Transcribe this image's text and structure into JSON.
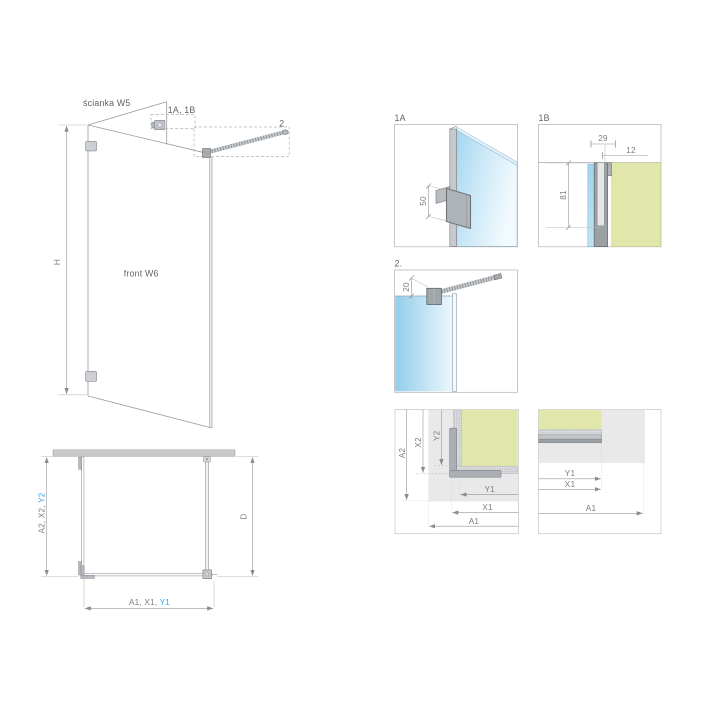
{
  "view3d": {
    "wall_panel_label": "ścianka W5",
    "front_panel_label": "front W6",
    "height_label": "H",
    "callout_1ab": "1A, 1B",
    "callout_2": "2"
  },
  "plan": {
    "left_dim_prefix": "A2, X2, ",
    "left_dim_highlight": "Y2",
    "depth_label": "D",
    "bottom_dim_prefix": "A1, X1, ",
    "bottom_dim_highlight": "Y1"
  },
  "detail_1a": {
    "title": "1A",
    "bracket_height": "50"
  },
  "detail_1b": {
    "title": "1B",
    "width_top": "29",
    "offset": "12",
    "depth": "81"
  },
  "detail_2": {
    "title": "2.",
    "clamp_offset": "20"
  },
  "corner_diagram": {
    "a2": "A2",
    "x2": "X2",
    "y2": "Y2",
    "y1": "Y1",
    "x1": "X1",
    "a1": "A1"
  },
  "wall_diagram": {
    "y1": "Y1",
    "x1": "X1",
    "a1": "A1"
  },
  "colors": {
    "accent": "#29A9E1",
    "glass": "#A6D8F0",
    "wall": "#E1E7AA"
  }
}
